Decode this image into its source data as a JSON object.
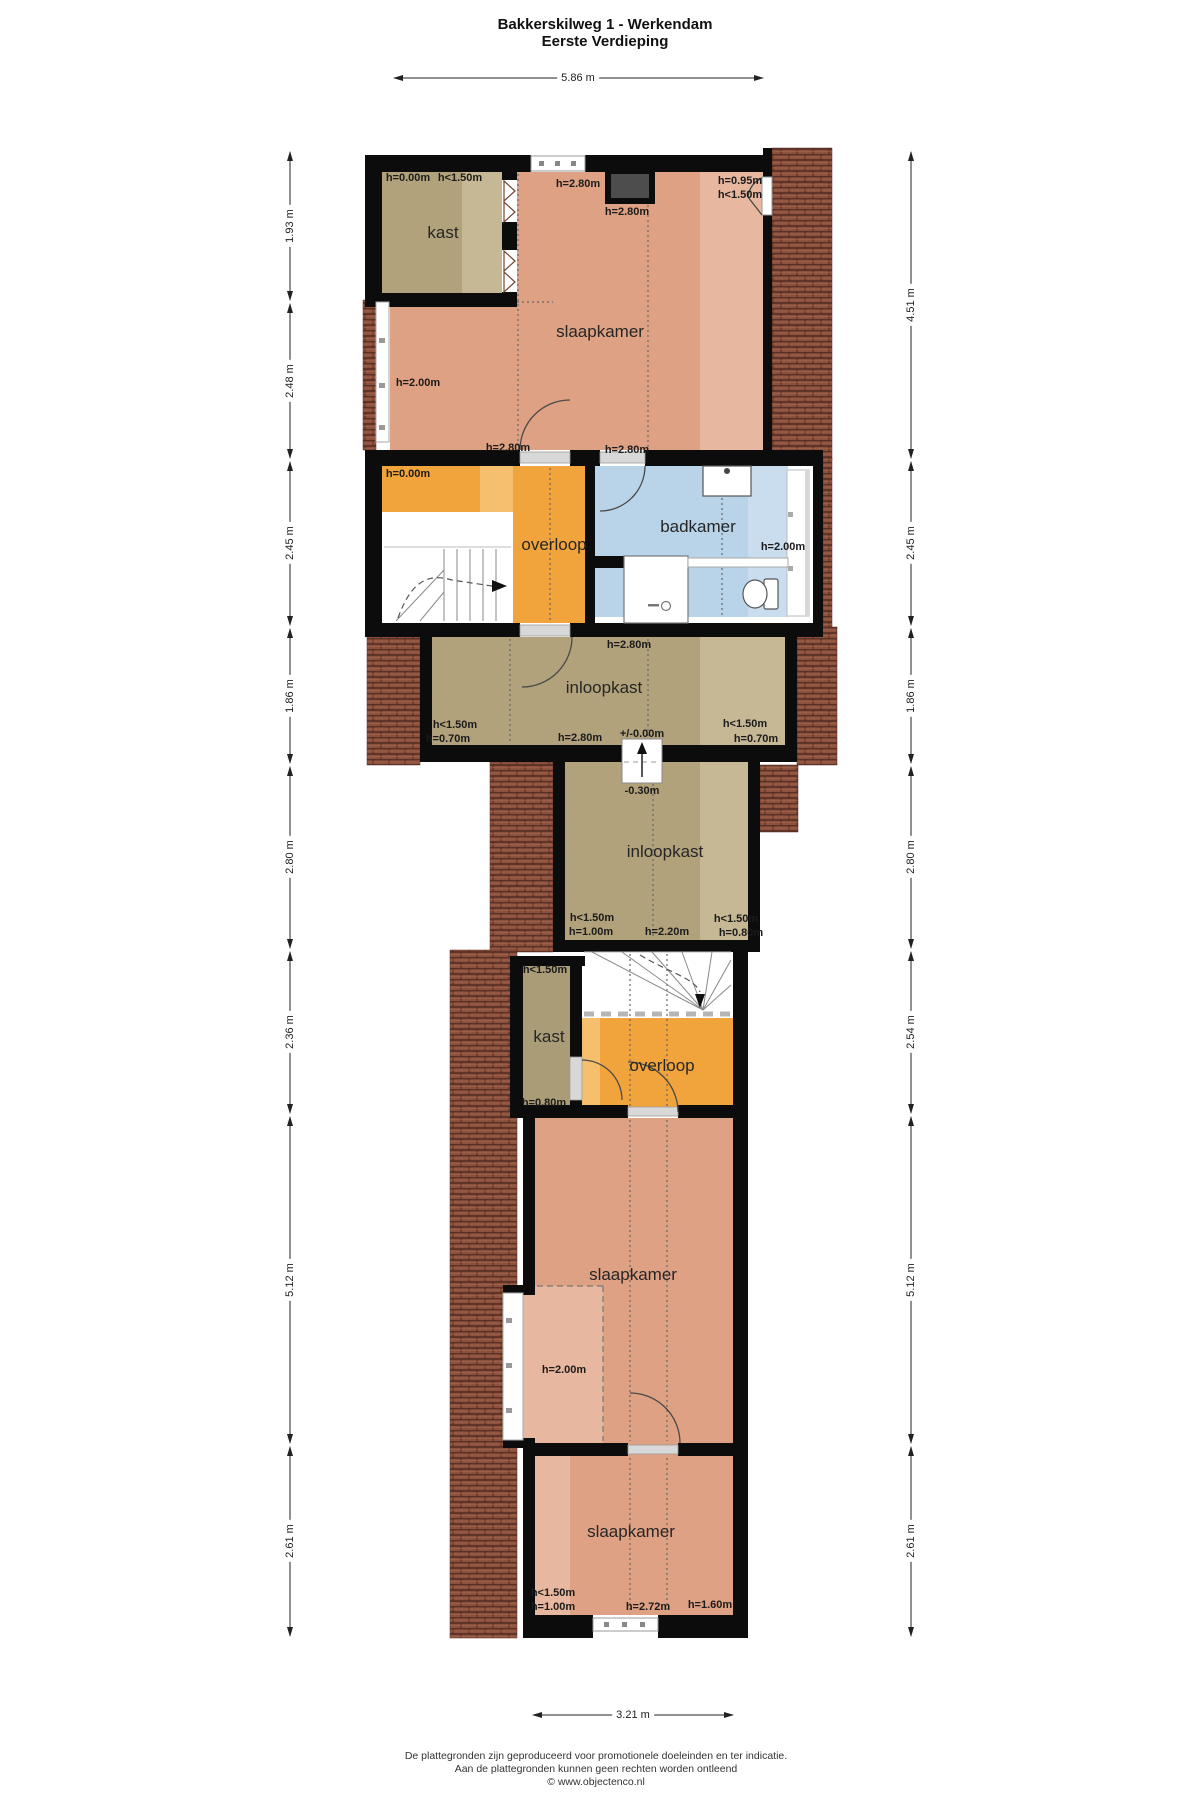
{
  "meta": {
    "title_line1": "Bakkerskilweg 1 - Werkendam",
    "title_line2": "Eerste Verdieping"
  },
  "footer": {
    "line1": "De plattegronden zijn geproduceerd voor promotionele doeleinden en ter indicatie.",
    "line2": "Aan de plattegronden kunnen geen rechten worden ontleend",
    "line3": "© www.objectenco.nl"
  },
  "dimensions": {
    "top": "5.86 m",
    "bottom": "3.21 m",
    "left": [
      "1.93 m",
      "2.48 m",
      "2.45 m",
      "1.86 m",
      "2.80 m",
      "2.36 m",
      "5.12 m",
      "2.61 m"
    ],
    "right": [
      "4.51 m",
      "2.45 m",
      "1.86 m",
      "2.80 m",
      "2.54 m",
      "5.12 m",
      "2.61 m"
    ]
  },
  "rooms": {
    "kast_top": "kast",
    "slaapkamer_top": "slaapkamer",
    "overloop_top": "overloop",
    "badkamer": "badkamer",
    "inloopkast_1": "inloopkast",
    "inloopkast_2": "inloopkast",
    "kast_mid": "kast",
    "overloop_mid": "overloop",
    "slaapkamer_mid": "slaapkamer",
    "slaapkamer_bottom": "slaapkamer"
  },
  "heights": [
    "h=0.00m",
    "h<1.50m",
    "h=2.80m",
    "h=2.80m",
    "h=0.95m",
    "h<1.50m",
    "h=2.00m",
    "h=2.80m",
    "h=2.80m",
    "h=0.00m",
    "h=2.00m",
    "h=2.80m",
    "h<1.50m",
    "h=0.70m",
    "h=2.80m",
    "+/-0.00m",
    "h<1.50m",
    "h=0.70m",
    "-0.30m",
    "h<1.50m",
    "h=1.00m",
    "h=2.20m",
    "h<1.50m",
    "h=0.80m",
    "h<1.50m",
    "h=0.80m",
    "h=2.00m",
    "h<1.50m",
    "h=1.00m",
    "h=2.72m",
    "h=1.60m"
  ],
  "colors": {
    "wall": "#0c0c0c",
    "floor_salmon": "#dfa183",
    "floor_salmon_light": "#e8b79f",
    "floor_tan": "#b2a27c",
    "floor_tan_light": "#c6b795",
    "floor_orange": "#f1a33c",
    "floor_orange_light": "#f6bf6e",
    "floor_blue": "#b9d3e8",
    "floor_blue_light": "#c9ddef",
    "roof_tile": "#8d523e",
    "chimney": "#4d4d4d"
  }
}
